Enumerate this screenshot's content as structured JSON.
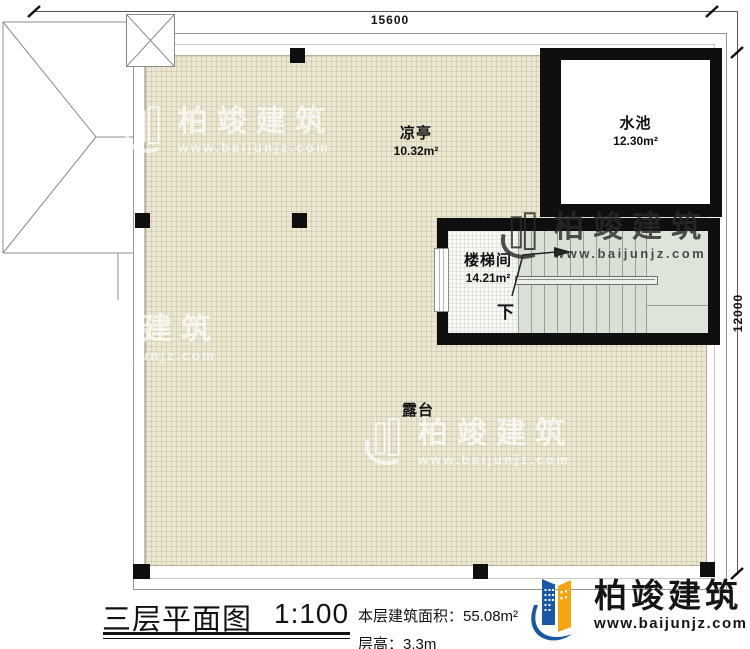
{
  "colors": {
    "wall": "#0f0f0f",
    "line_gray": "#969696",
    "terrace_fill": "#ebe7d2",
    "stair_fill": "#d9e0d5",
    "brand_blue": "#1a57a5",
    "brand_orange": "#f5a50e"
  },
  "dimensions": {
    "top_width": "15600",
    "right_height": "12000"
  },
  "rooms": [
    {
      "name": "凉亭",
      "area": "10.32m²"
    },
    {
      "name": "水池",
      "area": "12.30m²"
    },
    {
      "name": "楼梯间",
      "area": "14.21m²"
    },
    {
      "name": "露台"
    }
  ],
  "stair": {
    "direction_label": "下"
  },
  "title_block": {
    "title": "三层平面图",
    "scale": "1:100",
    "area_label": "本层建筑面积：",
    "area_value": "55.08m²",
    "floor_height_label": "层高：",
    "floor_height_value": "3.3m"
  },
  "branding": {
    "company_name": "柏竣建筑",
    "website": "www.baijunjz.com"
  },
  "watermark": {
    "company_name": "柏竣建筑",
    "website": "www.baijunjz.com"
  }
}
